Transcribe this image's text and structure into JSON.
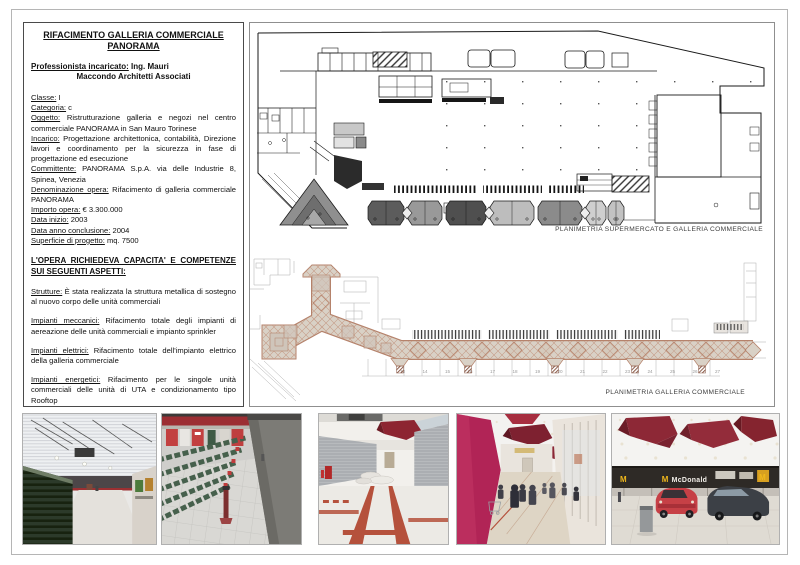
{
  "info_panel": {
    "title_line1": "RIFACIMENTO GALLERIA COMMERCIALE",
    "title_line2": "PANORAMA",
    "professional_label": "Professionista incaricato:",
    "professional_value": "Ing. Mauri",
    "professional_line2": "Maccondo Architetti Associati",
    "fields": [
      {
        "label": "Classe:",
        "value": "I"
      },
      {
        "label": "Categoria:",
        "value": "c"
      },
      {
        "label": "Oggetto:",
        "value": "Ristrutturazione galleria e negozi nel centro commerciale PANORAMA in San Mauro Torinese"
      },
      {
        "label": "Incarico:",
        "value": "Progettazione architettonica, contabilità, Direzione lavori e coordinamento per la sicurezza in fase di progettazione ed esecuzione"
      },
      {
        "label": "Committente:",
        "value": "PANORAMA S.p.A. via delle Industrie 8, Spinea, Venezia"
      },
      {
        "label": "Denominazione opera:",
        "value": "Rifacimento di galleria commerciale PANORAMA"
      },
      {
        "label": "Importo opera:",
        "value": "€ 3.300.000"
      },
      {
        "label": "Data inizio:",
        "value": "2003"
      },
      {
        "label": "Data anno conclusione:",
        "value": "2004"
      },
      {
        "label": "Superficie di progetto:",
        "value": "mq. 7500"
      }
    ],
    "section_heading": "L'OPERA RICHIEDEVA CAPACITA' E COMPETENZE SUI SEGUENTI ASPETTI:",
    "aspects": [
      {
        "label": "Strutture:",
        "value": "È stata realizzata la struttura metallica di sostegno al nuovo corpo delle unità commerciali"
      },
      {
        "label": "Impianti meccanici:",
        "value": "Rifacimento totale degli impianti di aereazione delle unità commerciali e impianto sprinkler"
      },
      {
        "label": "Impianti elettrici:",
        "value": "Rifacimento totale dell'impianto elettrico della galleria commerciale"
      },
      {
        "label": "Impianti energetici:",
        "value": "Rifacimento per le singole unità commerciali delle unità di UTA e condizionamento tipo Rooftop"
      }
    ]
  },
  "plans": {
    "supermarket_caption": "PLANIMETRIA SUPERMERCATO  E GALLERIA COMMERCIALE",
    "gallery_caption": "PLANIMETRIA GALLERIA COMMERCIALE",
    "gallery_unit_numbers": [
      "13",
      "14",
      "15",
      "16",
      "17",
      "18",
      "19",
      "20",
      "21",
      "22",
      "23",
      "24",
      "25",
      "26",
      "27"
    ],
    "colors": {
      "plan_line": "#1a1a1a",
      "gallery_line": "#b5826b",
      "gallery_fill": "#d9d1c6",
      "gallery_hatch": "#c49a85"
    }
  },
  "photos": [
    {
      "id": "supermarket-aisle-photo"
    },
    {
      "id": "checkout-area-photo"
    },
    {
      "id": "gallery-construction-photo"
    },
    {
      "id": "gallery-finished-photo"
    },
    {
      "id": "mcdonalds-court-photo",
      "sign_text": "McDonald"
    }
  ]
}
